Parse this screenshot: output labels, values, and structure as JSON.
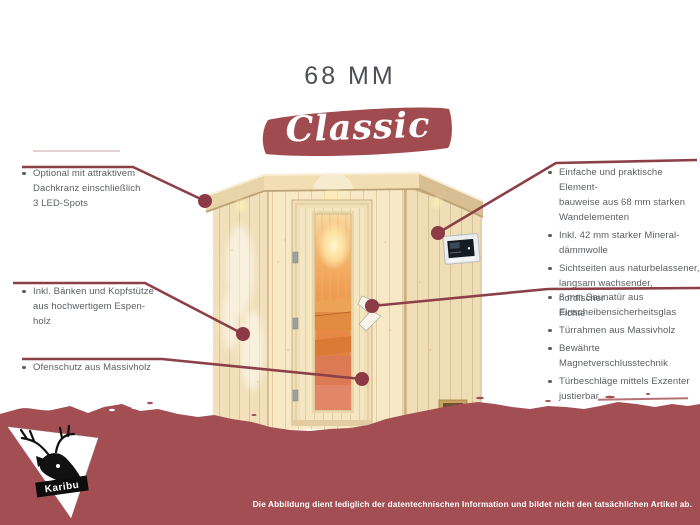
{
  "header": {
    "thickness_title": "68 MM",
    "series_name": "Classic"
  },
  "features_left": [
    {
      "text": "Optional mit attraktivem\nDachkranz einschließlich\n3 LED-Spots"
    },
    {
      "text": "Inkl. Bänken und Kopfstütze\naus hochwertigem Espen-\nholz"
    },
    {
      "text": "Ofenschutz aus Massivholz"
    }
  ],
  "features_right_top": [
    {
      "text": "Einfache und praktische Element-\nbauweise aus 68 mm starken\nWandelementen"
    },
    {
      "text": "Inkl. 42 mm starker Mineral-\ndämmwolle"
    },
    {
      "text": "Sichtseiten aus naturbelassener,\nlangsam wachsender, nordischer\nFichte"
    }
  ],
  "features_right_bottom": [
    {
      "text": "8 mm Saunatür aus\nEinscheibensicherheitsglas"
    },
    {
      "text": "Türrahmen aus Massivholz"
    },
    {
      "text": "Bewährte Magnetverschlusstechnik"
    },
    {
      "text": "Türbeschläge mittels Exzenter\njustierbar"
    }
  ],
  "footer": {
    "disclaimer": "Die Abbildung dient lediglich der datentechnischen Information und bildet nicht den tatsächlichen Artikel ab.",
    "brand": "Karibu"
  },
  "colors": {
    "maroon": "#a24e52",
    "brush": "#a04b50",
    "line": "#8d3f47",
    "dot": "#8c3a45",
    "title_gray": "#4d4f55",
    "text_gray": "#5b5e62"
  },
  "illustration": {
    "name": "corner-sauna-68mm",
    "elements": [
      "roof-crown",
      "led-spot",
      "wall-element",
      "sauna-door",
      "door-glass",
      "door-handle",
      "control-unit",
      "interior-bench",
      "air-vent"
    ]
  }
}
